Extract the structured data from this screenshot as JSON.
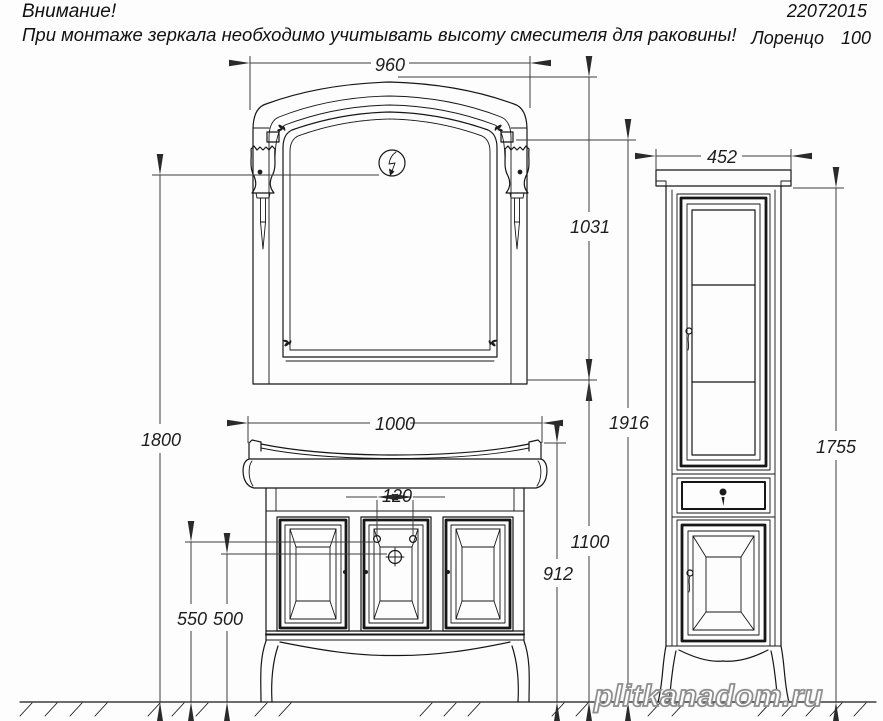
{
  "header": {
    "warning_line1": "Внимание!",
    "warning_line2": "При монтаже зеркала необходимо учитывать высоту смесителя для раковины!",
    "doc_number": "22072015",
    "model_name": "Лоренцо 100"
  },
  "dimensions": {
    "mirror_width": "960",
    "mirror_height": "1031",
    "lamp_height": "1800",
    "vanity_width": "1000",
    "faucet_hole_spacing": "120",
    "hole_height_left": "550",
    "hole_height_right": "500",
    "vanity_height": "912",
    "mirror_bottom_height": "1100",
    "total_height": "1916",
    "cabinet_width": "452",
    "cabinet_height": "1755"
  },
  "watermark": {
    "text": "plitkanadom.ru"
  }
}
